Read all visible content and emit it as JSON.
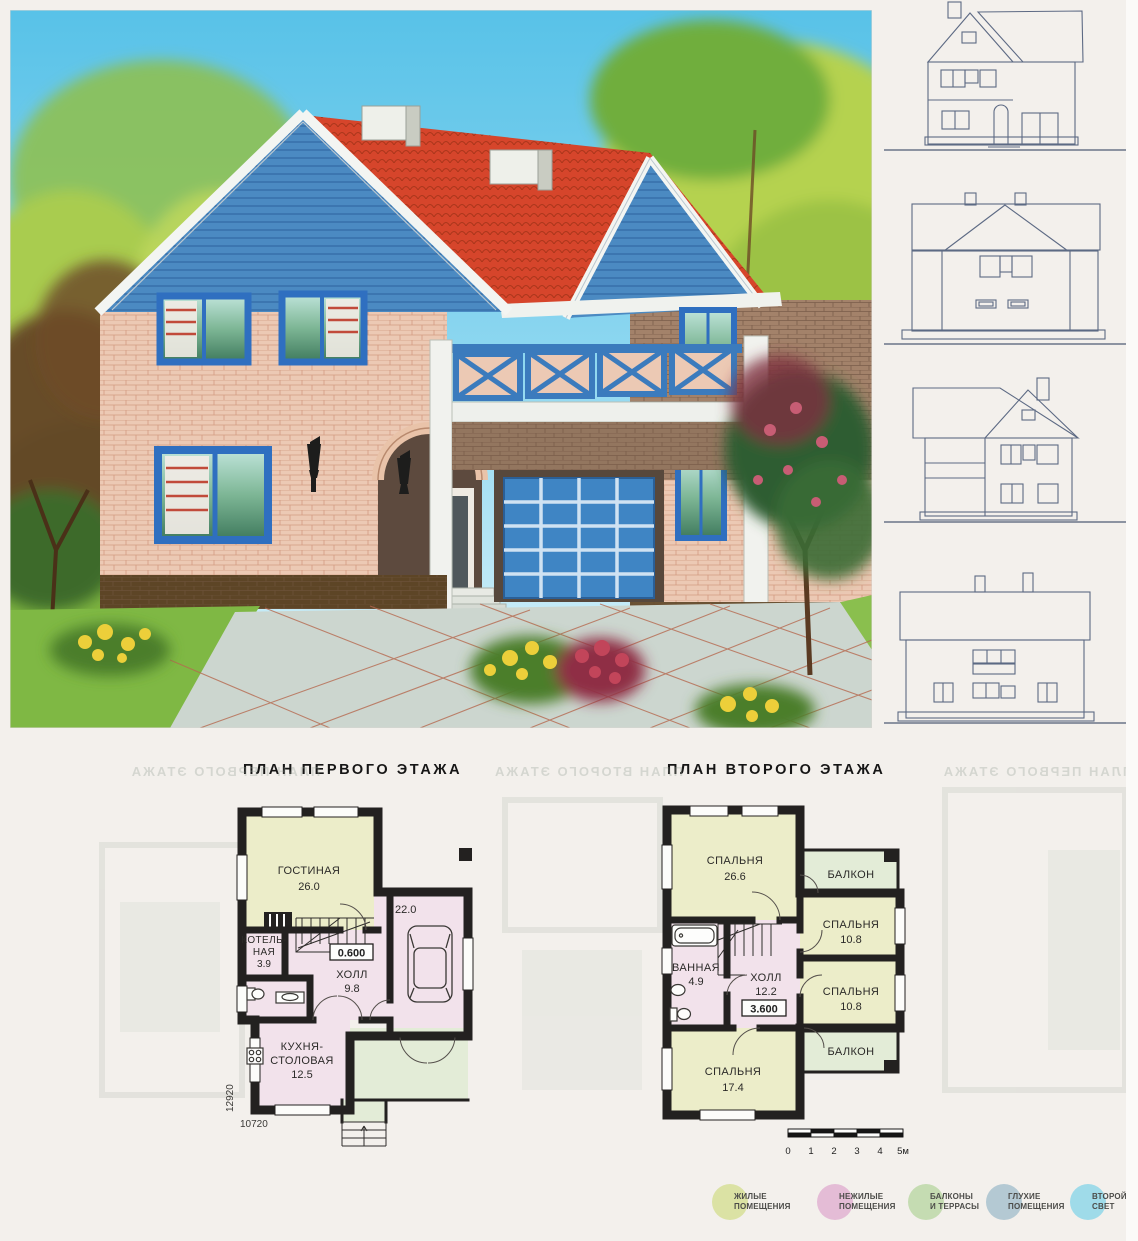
{
  "plans": {
    "first_floor": {
      "title": "ПЛАН ПЕРВОГО ЭТАЖА",
      "rooms": [
        {
          "name": "ГОСТИНАЯ",
          "area": "26.0"
        },
        {
          "name": "КОТЕЛЬ-",
          "name2": "НАЯ",
          "area": "3.9"
        },
        {
          "name": "ХОЛЛ",
          "area": "9.8"
        },
        {
          "name": "КУХНЯ-",
          "name2": "СТОЛОВАЯ",
          "area": "12.5"
        }
      ],
      "garage_area": "22.0",
      "level_mark": "0.600",
      "dim_width": "10720",
      "dim_height": "12920"
    },
    "second_floor": {
      "title": "ПЛАН ВТОРОГО ЭТАЖА",
      "rooms": [
        {
          "name": "СПАЛЬНЯ",
          "area": "26.6"
        },
        {
          "name": "БАЛКОН"
        },
        {
          "name": "СПАЛЬНЯ",
          "area": "10.8"
        },
        {
          "name": "СПАЛЬНЯ",
          "area": "10.8"
        },
        {
          "name": "ВАННАЯ",
          "area": "4.9"
        },
        {
          "name": "ХОЛЛ",
          "area": "12.2"
        },
        {
          "name": "СПАЛЬНЯ",
          "area": "17.4"
        },
        {
          "name": "БАЛКОН"
        }
      ],
      "level_mark": "3.600"
    }
  },
  "scale_bar": {
    "ticks": [
      "0",
      "1",
      "2",
      "3",
      "4",
      "5м"
    ]
  },
  "legend": {
    "items": [
      {
        "line1": "ЖИЛЫЕ",
        "line2": "ПОМЕЩЕНИЯ",
        "color": "#dbe2a4"
      },
      {
        "line1": "НЕЖИЛЫЕ",
        "line2": "ПОМЕЩЕНИЯ",
        "color": "#e4bcd6"
      },
      {
        "line1": "БАЛКОНЫ",
        "line2": "И ТЕРРАСЫ",
        "color": "#c5dcb2"
      },
      {
        "line1": "ГЛУХИЕ",
        "line2": "ПОМЕЩЕНИЯ",
        "color": "#b4c9d3"
      },
      {
        "line1": "ВТОРОЙ",
        "line2": "СВЕТ",
        "color": "#9fdbe9"
      }
    ]
  },
  "palette": {
    "plan_living": "#ecedc9",
    "plan_utility": "#f2e2eb",
    "plan_balcony": "#e3ecd7",
    "plan_wall": "#232120",
    "roof_red": "#d6452b",
    "facade_blue": "#4b8ac2",
    "brick_pink": "#ecc9b4",
    "garage_door_blue": "#3f85c4",
    "elevation_line": "#5d6a84"
  }
}
